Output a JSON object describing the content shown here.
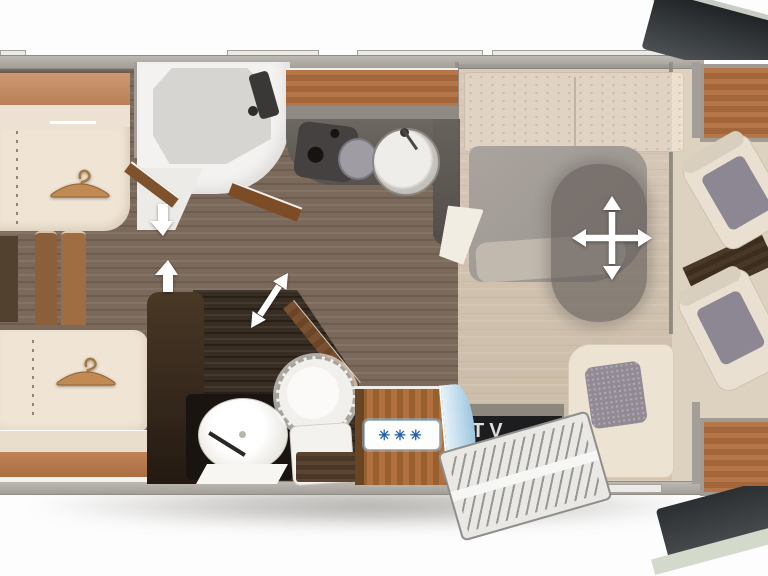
{
  "labels": {
    "tv": "TV"
  },
  "fridge": {
    "freezer_icon": "✳✳✳",
    "icon_color": "#1e5fae"
  },
  "icons": {
    "wardrobe_rear": "hanger-icon",
    "wardrobe_front": "hanger-icon",
    "bed_move": "four-way-arrow-icon",
    "door_swing": "double-diagonal-arrow-icon",
    "walkway_down": "down-arrow-icon",
    "walkway_up": "up-arrow-icon",
    "freezer": "snowflake-asterisk-icon"
  },
  "colors": {
    "wood": "#a86a3c",
    "wood_dark": "#4a3826",
    "floor_hall": "#7b6a5b",
    "floor_bedroom": "#ddcdb9",
    "upholstery_cream": "#efe3d2",
    "counter_gray": "#5f5a55",
    "bathroom_dark": "#352b21",
    "tv_band": "#1d1d1f",
    "arrow_white": "#ffffff",
    "overlay_gray": "#67605b",
    "door_blue": "#aed0e4"
  }
}
